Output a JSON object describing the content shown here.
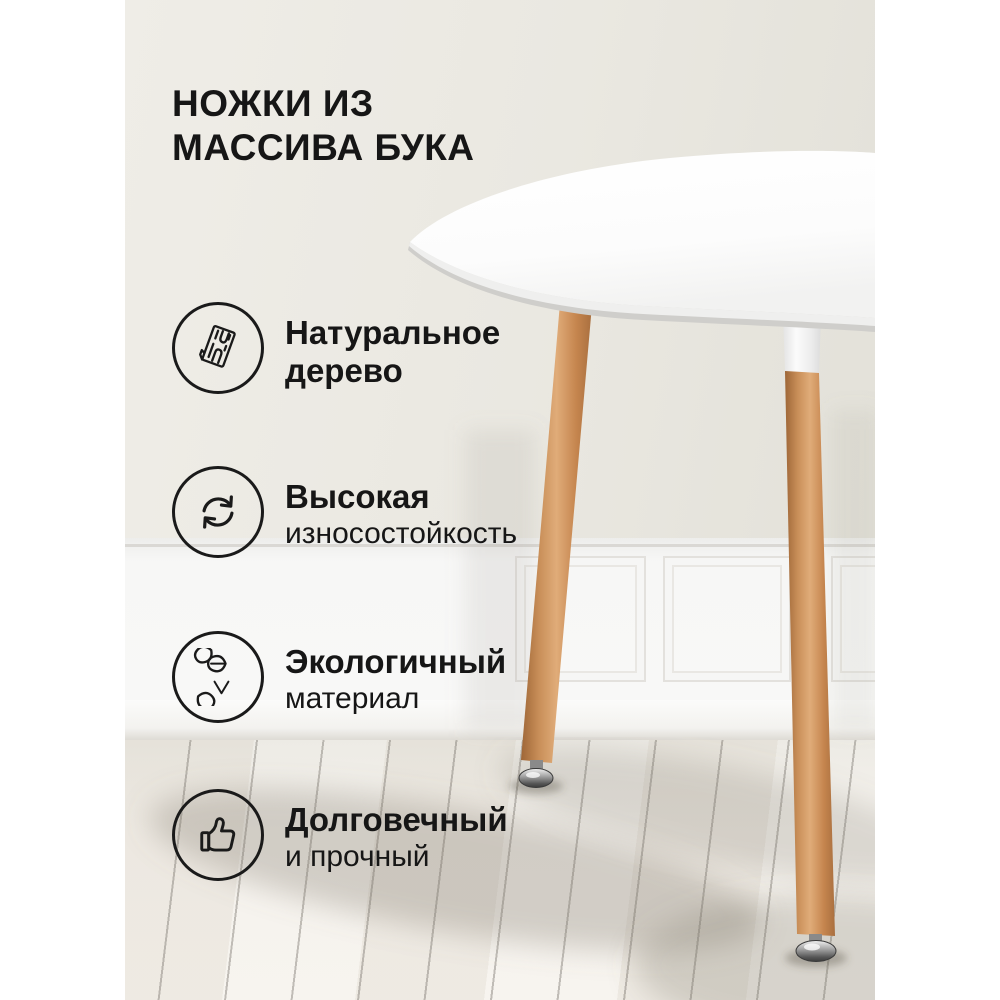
{
  "title": {
    "line1": "НОЖКИ ИЗ",
    "line2": "МАССИВА БУКА"
  },
  "features": [
    {
      "icon": "wood-plank-icon",
      "line1": "Натуральное",
      "line2": "дерево"
    },
    {
      "icon": "cycle-arrows-icon",
      "line1": "Высокая",
      "line2": "износостойкость"
    },
    {
      "icon": "eco-leaves-icon",
      "line1": "Экологичный",
      "line2": "материал"
    },
    {
      "icon": "thumbs-up-icon",
      "line1": "Долговечный",
      "line2": "и прочный"
    }
  ],
  "colors": {
    "text": "#161616",
    "page_background": "#ffffff",
    "wall_beige": "#eae8e1",
    "wainscot_white": "#f7f7f6",
    "floor_white_wood": "#f5f2ed",
    "tabletop_white": "#ffffff",
    "leg_wood": "#c88e58",
    "chrome_foot": "#8f8f8f"
  }
}
